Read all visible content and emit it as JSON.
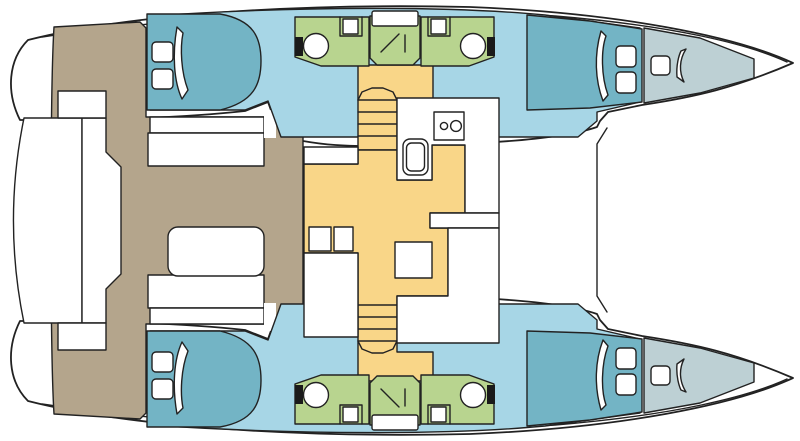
{
  "diagram": {
    "type": "floorplan",
    "subject": "catamaran sailing yacht interior layout, top view",
    "orientation": "bow-right, stern-left",
    "colors": {
      "outline": "#222222",
      "deck_white": "#ffffff",
      "cabin_floor_blue": "#a7d6e6",
      "berth_teal": "#73b4c5",
      "forepeak_pale": "#bdd0d4",
      "bathroom_green": "#b8d48f",
      "saloon_orange": "#f9d688",
      "cockpit_brown": "#b4a58c",
      "fixture_dark": "#1a1a1a"
    },
    "rooms": {
      "saloon": {
        "floor": "orange",
        "fixtures": [
          "galley counter",
          "stove 2 burners",
          "galley sink",
          "table",
          "2 stools",
          "front door"
        ]
      },
      "cockpit": {
        "floor": "brown",
        "fixtures": [
          "cockpit table",
          "2 bench seats",
          "aft platform"
        ]
      },
      "aft_cabins": {
        "count": 2,
        "fixtures_each": [
          "double berth",
          "2 pillows",
          "hatch"
        ]
      },
      "forward_cabins": {
        "count": 2,
        "fixtures_each": [
          "berth",
          "2 deck hatches",
          "door"
        ]
      },
      "bathrooms": {
        "count": 4,
        "fixtures_each": [
          "toilet",
          "sink"
        ]
      },
      "showers": {
        "count": 2,
        "fixtures_each": [
          "shower tray",
          "skylight"
        ]
      },
      "forepeaks": {
        "count": 2,
        "fixtures_each": [
          "deck hatch"
        ]
      },
      "staircases": {
        "count": 2,
        "steps_visible": 4
      }
    }
  }
}
